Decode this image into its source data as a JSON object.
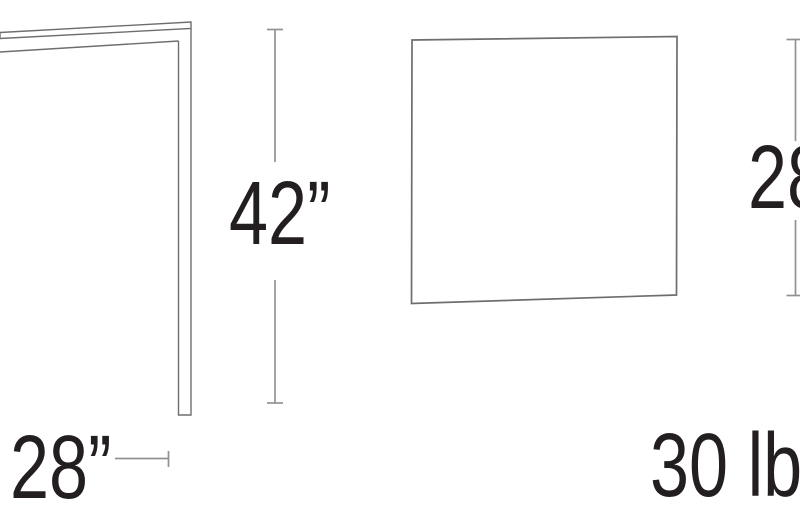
{
  "diagram": {
    "type": "furniture-dimension-drawing",
    "height_dimension": "42”",
    "depth_dimension": "28”",
    "width_dimension": "28",
    "weight": "30 lb"
  },
  "colors": {
    "background": "#ffffff",
    "text": "#231f20",
    "drawing_line": "#6d6e70",
    "dimension_line": "#8f9194"
  }
}
